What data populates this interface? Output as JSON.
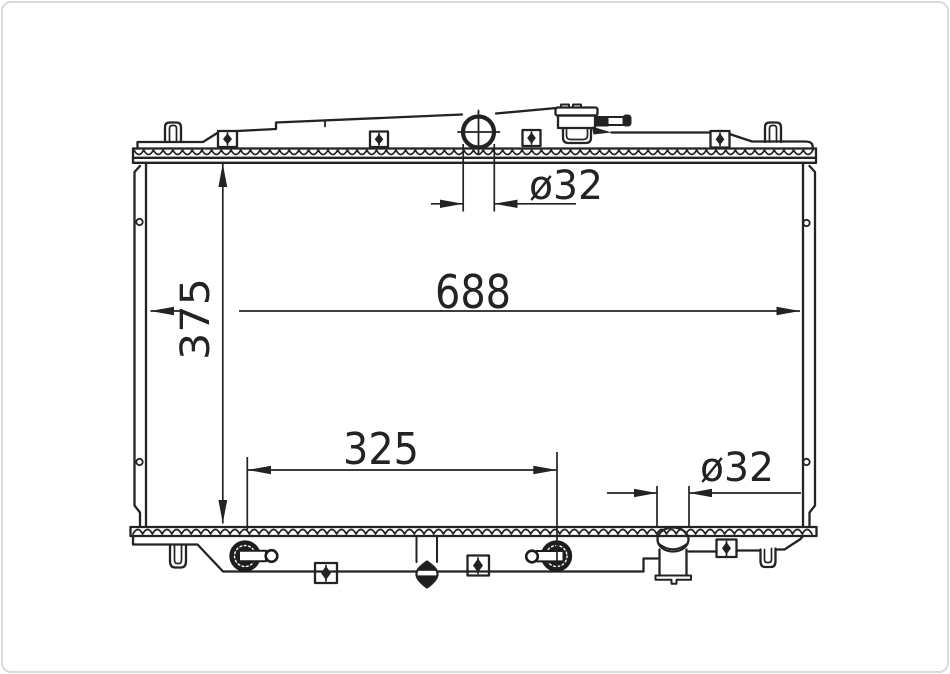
{
  "drawing": {
    "dimension_labels": {
      "overall_core_width": "688",
      "overall_core_height": "375",
      "cooler_fitting_span": "325",
      "inlet_pipe_diameter": "ø32",
      "outlet_pipe_diameter": "ø32"
    },
    "colors": {
      "line": "#232323",
      "background": "#ffffff",
      "frame": "#d9d9d9"
    }
  }
}
